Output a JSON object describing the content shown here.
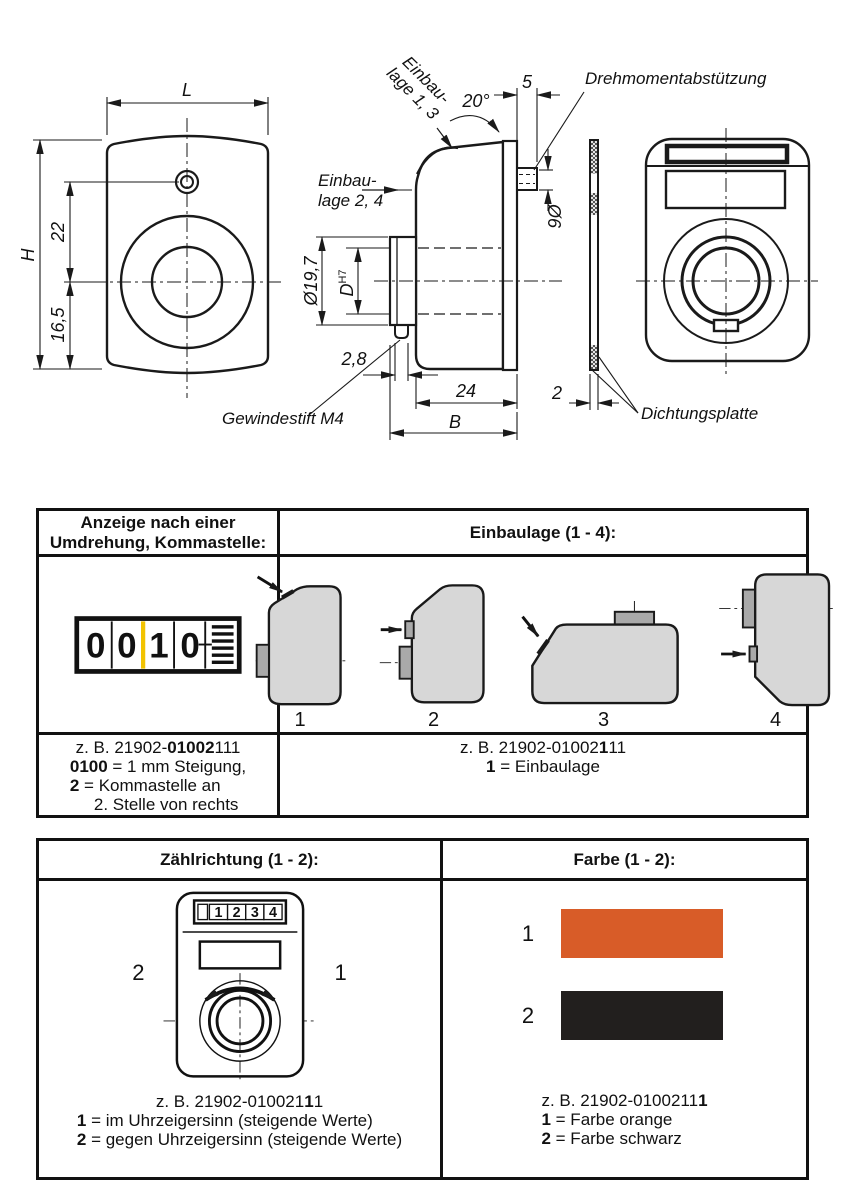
{
  "drawing": {
    "dims": {
      "L": "L",
      "H": "H",
      "v22": "22",
      "v165": "16,5",
      "deg20": "20°",
      "v5": "5",
      "dia6": "Ø6",
      "dia197": "Ø19,7",
      "D": "D",
      "H7": "H7",
      "v28": "2,8",
      "v24": "24",
      "B": "B",
      "v2": "2"
    },
    "labels": {
      "einbau13_l1": "Einbau-",
      "einbau13_l2": "lage 1, 3",
      "einbau24_l1": "Einbau-",
      "einbau24_l2": "lage 2, 4",
      "drehmoment": "Drehmomentabstützung",
      "gewindestift": "Gewindestift M4",
      "dichtung": "Dichtungsplatte"
    }
  },
  "table1": {
    "header_left_l1": "Anzeige nach einer",
    "header_left_l2": "Umdrehung, Kommastelle:",
    "header_right": "Einbaulage (1 - 4):",
    "counter": {
      "d1": "0",
      "d2": "0",
      "d3": "1",
      "d4": "0",
      "separator_color": "#f2c300"
    },
    "positions": {
      "p1": "1",
      "p2": "2",
      "p3": "3",
      "p4": "4"
    },
    "left_code": {
      "pre": "z. B. 21902-",
      "bold": "01002",
      "suf": "111"
    },
    "left_l2": {
      "bold": "0100",
      "rest": " = 1 mm Steigung,"
    },
    "left_l3": {
      "bold": "2",
      "rest": " = Kommastelle an"
    },
    "left_l4": "2. Stelle von rechts",
    "right_code": {
      "pre": "z. B. 21902-01002",
      "bold": "1",
      "suf": "11"
    },
    "right_l2": {
      "bold": "1",
      "rest": " = Einbaulage"
    }
  },
  "table2": {
    "header_left": "Zählrichtung (1 - 2):",
    "header_right": "Farbe (1 - 2):",
    "device_digits": {
      "d1": "1",
      "d2": "2",
      "d3": "3",
      "d4": "4"
    },
    "dir_left": "2",
    "dir_right": "1",
    "left_code": {
      "pre": "z. B. 21902-010021",
      "bold": "1",
      "suf": "1"
    },
    "left_l2": {
      "bold": "1",
      "rest": " = im Uhrzeigersinn (steigende Werte)"
    },
    "left_l3": {
      "bold": "2",
      "rest": " = gegen Uhrzeigersinn (steigende Werte)"
    },
    "swatches": {
      "s1": {
        "label": "1",
        "color": "#d85c28",
        "name": "orange"
      },
      "s2": {
        "label": "2",
        "color": "#221f1e",
        "name": "schwarz"
      }
    },
    "right_code": {
      "pre": "z. B. 21902-0100211",
      "bold": "1",
      "suf": ""
    },
    "right_l2": {
      "bold": "1",
      "rest": " = Farbe orange"
    },
    "right_l3": {
      "bold": "2",
      "rest": " = Farbe schwarz"
    }
  }
}
